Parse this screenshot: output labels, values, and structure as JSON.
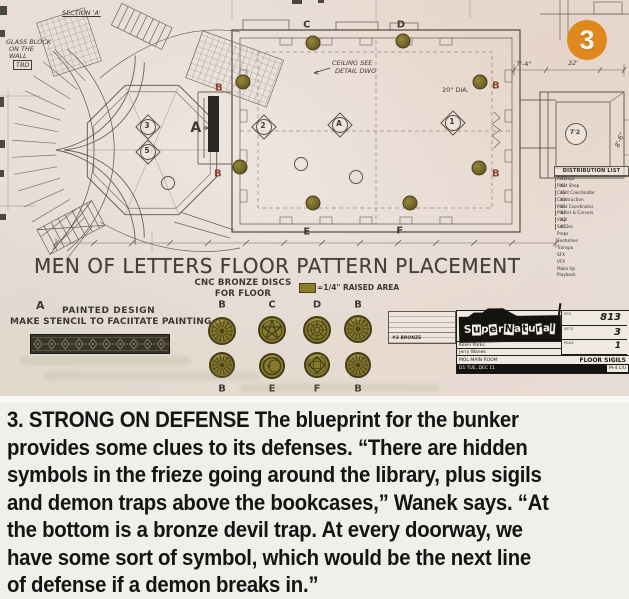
{
  "badge": {
    "number": "3",
    "color": "#e0881c"
  },
  "blueprint": {
    "title": "MEN OF LETTERS FLOOR PATTERN PLACEMENT",
    "legend": {
      "cnc_line1": "CNC BRONZE DISCS",
      "cnc_line2": "FOR FLOOR",
      "raised": "=1/4\" RAISED AREA"
    },
    "painted_design": {
      "label": "A",
      "line1": "PAINTED DESIGN",
      "line2": "MAKE STENCIL TO FACIITATE PAINTING"
    },
    "plan_labels": [
      {
        "t": "B",
        "x": 219,
        "y": 88,
        "c": "red"
      },
      {
        "t": "B",
        "x": 218,
        "y": 174,
        "c": "red"
      },
      {
        "t": "C",
        "x": 307,
        "y": 25,
        "c": "dark"
      },
      {
        "t": "D",
        "x": 401,
        "y": 25,
        "c": "dark"
      },
      {
        "t": "B",
        "x": 496,
        "y": 86,
        "c": "red"
      },
      {
        "t": "B",
        "x": 496,
        "y": 174,
        "c": "red"
      },
      {
        "t": "E",
        "x": 307,
        "y": 232,
        "c": "dark"
      },
      {
        "t": "F",
        "x": 400,
        "y": 231,
        "c": "dark"
      },
      {
        "t": "A",
        "x": 196,
        "y": 128,
        "c": "dark",
        "big": true
      }
    ],
    "annotations": [
      {
        "t": "SECTION 'A'",
        "x": 62,
        "y": 13,
        "cls": "underl"
      },
      {
        "t": "GLASS BLOCK",
        "x": 6,
        "y": 42
      },
      {
        "t": "ON THE",
        "x": 9,
        "y": 49
      },
      {
        "t": "WALL",
        "x": 9,
        "y": 56
      },
      {
        "t": "TBD",
        "x": 13,
        "y": 65,
        "cls": "boxed"
      },
      {
        "t": "CEILING SEE",
        "x": 332,
        "y": 63
      },
      {
        "t": "DETAIL DWG",
        "x": 335,
        "y": 71
      },
      {
        "t": "20\" DIA.",
        "x": 442,
        "y": 90,
        "cls": "plain"
      },
      {
        "t": "32'",
        "x": 568,
        "y": 63
      },
      {
        "t": "7'-4\"",
        "x": 516,
        "y": 64,
        "cls": "plain"
      },
      {
        "t": "8'-6\"",
        "x": 612,
        "y": 140,
        "cls": "rot"
      }
    ],
    "markers": [
      {
        "label": "3",
        "x": 147,
        "y": 126,
        "kind": "diamond"
      },
      {
        "label": "5",
        "x": 147,
        "y": 151,
        "kind": "diamond"
      },
      {
        "label": "2",
        "x": 263,
        "y": 126,
        "kind": "diamond"
      },
      {
        "label": "A",
        "x": 339,
        "y": 124,
        "kind": "diamond"
      },
      {
        "label": "1",
        "x": 452,
        "y": 122,
        "kind": "diamond"
      },
      {
        "label": "7'2",
        "x": 575,
        "y": 133,
        "kind": "circle"
      },
      {
        "label": "",
        "x": 300,
        "y": 163,
        "kind": "small"
      },
      {
        "label": "",
        "x": 167,
        "y": 182,
        "kind": "small"
      },
      {
        "label": "",
        "x": 355,
        "y": 176,
        "kind": "small"
      }
    ],
    "wall_discs": [
      {
        "x": 243,
        "y": 82
      },
      {
        "x": 240,
        "y": 167
      },
      {
        "x": 313,
        "y": 43
      },
      {
        "x": 403,
        "y": 41
      },
      {
        "x": 480,
        "y": 82
      },
      {
        "x": 479,
        "y": 168
      },
      {
        "x": 313,
        "y": 203
      },
      {
        "x": 410,
        "y": 203
      }
    ],
    "disc_chart": {
      "top": [
        {
          "label": "B",
          "x": 222,
          "y": 331
        },
        {
          "label": "C",
          "x": 272,
          "y": 330
        },
        {
          "label": "D",
          "x": 317,
          "y": 330
        },
        {
          "label": "B",
          "x": 358,
          "y": 329
        }
      ],
      "bottom": [
        {
          "label": "B",
          "x": 222,
          "y": 365
        },
        {
          "label": "E",
          "x": 272,
          "y": 366
        },
        {
          "label": "F",
          "x": 317,
          "y": 365
        },
        {
          "label": "B",
          "x": 358,
          "y": 365
        }
      ]
    },
    "distribution": {
      "title": "DISTRIBUTION LIST",
      "rows": [
        [
          "Art Dept",
          "X1"
        ],
        [
          "Paint Shop",
          "X1"
        ],
        [
          "Const Coordinator",
          "X2"
        ],
        [
          "Construction",
          "X3"
        ],
        [
          "Paint Coordinator",
          "X1"
        ],
        [
          "Plaster & Carvers",
          "X2"
        ],
        [
          "Vinyl",
          "X2"
        ],
        [
          "Set Dec",
          "X1"
        ],
        [
          "Props",
          ""
        ],
        [
          "Costumes",
          ""
        ],
        [
          "Transpo",
          ""
        ],
        [
          "SFX",
          ""
        ],
        [
          "VFX",
          ""
        ],
        [
          "Make Up",
          ""
        ],
        [
          "Playback",
          ""
        ]
      ]
    },
    "title_block": {
      "logo": "SuperNatural",
      "eps_label": "EPS",
      "eps": "813",
      "sets_label": "SETS",
      "sets": "3",
      "page_label": "PAGE",
      "page": "1",
      "crew1": "Kevin Parks",
      "crew2": "Jerry Wanek",
      "set_name": "MOL MAIN ROOM",
      "sheet": "FLOOR SIGILS",
      "date": "D1 TUE, DEC 11",
      "drawn": "M-4 LIU",
      "spec_note": "#3 BRONZE"
    }
  },
  "caption": {
    "lines": [
      "3. STRONG ON DEFENSE The blueprint for the bunker",
      "provides some clues to its defenses. “There are hidden",
      "symbols in the frieze going around the library, plus sigils",
      "and demon traps above the bookcases,” Wanek says. “At",
      "the bottom is a bronze devil trap. At every doorway, we",
      "have some sort of symbol, which would be the next line",
      "of defense if a demon breaks in.”"
    ]
  }
}
